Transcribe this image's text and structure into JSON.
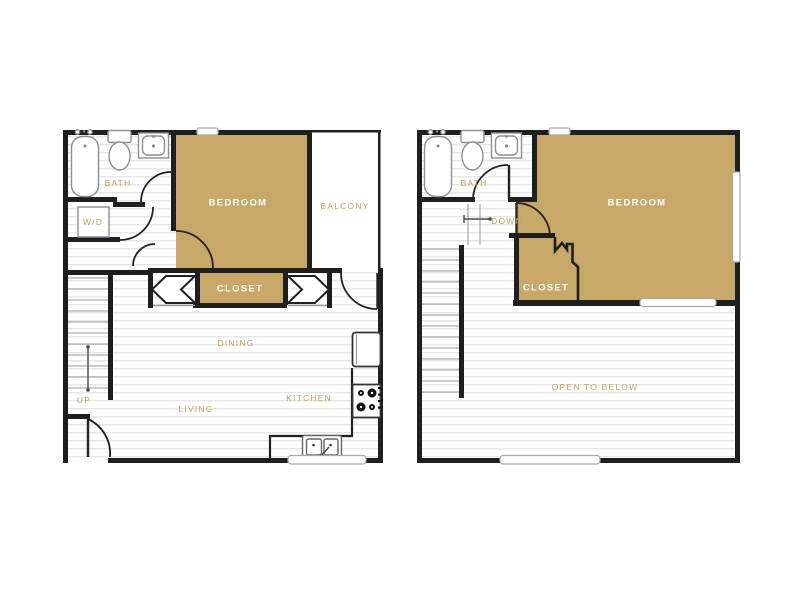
{
  "palette": {
    "tan_fill": "#C8A869",
    "wall": "#1F1F1F",
    "hatch_line": "#E3E3E3",
    "gold_text": "#C2A061",
    "fixture_gray": "#8F8F8F"
  },
  "floor1": {
    "labels": {
      "bath": "BATH",
      "wd": "W/D",
      "bedroom": "BEDROOM",
      "balcony": "BALCONY",
      "closet": "CLOSET",
      "dining": "DINING",
      "kitchen": "KITCHEN",
      "living": "LIVING",
      "up": "UP"
    }
  },
  "floor2": {
    "labels": {
      "bath": "BATH",
      "down": "DOWN",
      "bedroom": "BEDROOM",
      "closet": "CLOSET",
      "open_to_below": "OPEN TO BELOW"
    }
  }
}
